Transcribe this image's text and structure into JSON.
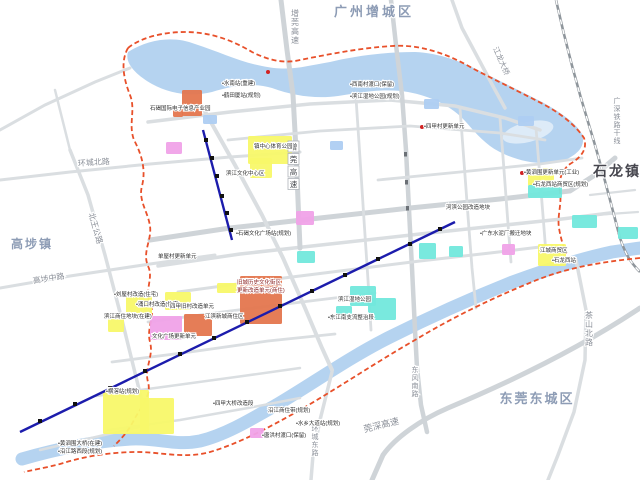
{
  "map": {
    "kind": "town-planning-map",
    "colors": {
      "river": "#b5d3f0",
      "river_light": "#ddebf8",
      "road": "#dadee1",
      "road_major": "#cfd4d8",
      "rail": "#8f969c",
      "boundary": "#e8502a",
      "metro": "#1c1cac",
      "station": "#111111",
      "parcel_yellow": "#f8f869",
      "parcel_pink": "#f0a2e8",
      "parcel_cyan": "#72e8dc",
      "parcel_orange": "#e4764e",
      "pond": "#aecdf2",
      "region_text": "#8d9cb5",
      "road_text": "#8a8f98",
      "poi_text": "#2e2e2e"
    },
    "regions": [
      {
        "id": "guangzhou-zengcheng",
        "label": "广州增城区",
        "x": 374,
        "y": 16,
        "size": 13,
        "color": "#8d9cb5",
        "spacing": 3,
        "bold": true
      },
      {
        "id": "shilong",
        "label": "石龙镇",
        "x": 617,
        "y": 176,
        "size": 14,
        "color": "#46464e",
        "spacing": 2,
        "bold": true
      },
      {
        "id": "dongguan-dongcheng",
        "label": "东莞东城区",
        "x": 537,
        "y": 403,
        "size": 13,
        "color": "#8d9cb5",
        "spacing": 2,
        "bold": true
      },
      {
        "id": "gaobu",
        "label": "高埗镇",
        "x": 32,
        "y": 248,
        "size": 12,
        "color": "#8d9cb5",
        "spacing": 2,
        "bold": true
      }
    ],
    "road_labels": [
      {
        "label": "环城北路",
        "x": 94,
        "y": 165,
        "rotate": -4,
        "size": 8
      },
      {
        "label": "北王公路",
        "x": 93,
        "y": 229,
        "rotate": 74,
        "size": 8
      },
      {
        "label": "高埗中路",
        "x": 49,
        "y": 281,
        "rotate": -9,
        "size": 8
      },
      {
        "label": "增莞高速",
        "x": 295,
        "y": 8,
        "vertical": true,
        "size": 8
      },
      {
        "label": "江龙大桥",
        "x": 499,
        "y": 62,
        "rotate": 66,
        "size": 7.5
      },
      {
        "label": "广深铁路干线",
        "x": 617,
        "y": 96,
        "vertical": true,
        "size": 7
      },
      {
        "label": "茶山北路",
        "x": 589,
        "y": 310,
        "vertical": true,
        "size": 8
      },
      {
        "label": "东风南路",
        "x": 415,
        "y": 365,
        "vertical": true,
        "size": 7
      },
      {
        "label": "环城东路",
        "x": 315,
        "y": 424,
        "vertical": true,
        "size": 7
      },
      {
        "label": "莞深高速",
        "x": 382,
        "y": 428,
        "rotate": -14,
        "size": 9
      }
    ],
    "expressway_shield": {
      "chars": [
        "增",
        "莞",
        "高",
        "速"
      ],
      "x": 288,
      "y": 141,
      "box": 11
    },
    "parcels": [
      {
        "color": "parcel_orange",
        "x": 182,
        "y": 90,
        "w": 20,
        "h": 26
      },
      {
        "color": "parcel_orange",
        "x": 173,
        "y": 108,
        "w": 10,
        "h": 9
      },
      {
        "color": "parcel_orange",
        "x": 240,
        "y": 276,
        "w": 42,
        "h": 48
      },
      {
        "color": "parcel_orange",
        "x": 184,
        "y": 314,
        "w": 28,
        "h": 22
      },
      {
        "color": "parcel_yellow",
        "x": 248,
        "y": 136,
        "w": 44,
        "h": 28
      },
      {
        "color": "parcel_yellow",
        "x": 250,
        "y": 158,
        "w": 22,
        "h": 20
      },
      {
        "color": "parcel_yellow",
        "x": 538,
        "y": 244,
        "w": 28,
        "h": 22
      },
      {
        "color": "parcel_yellow",
        "x": 528,
        "y": 168,
        "w": 26,
        "h": 18
      },
      {
        "color": "parcel_yellow",
        "x": 103,
        "y": 390,
        "w": 46,
        "h": 44
      },
      {
        "color": "parcel_yellow",
        "x": 140,
        "y": 398,
        "w": 34,
        "h": 36
      },
      {
        "color": "parcel_yellow",
        "x": 126,
        "y": 294,
        "w": 26,
        "h": 22
      },
      {
        "color": "parcel_yellow",
        "x": 165,
        "y": 292,
        "w": 26,
        "h": 18
      },
      {
        "color": "parcel_yellow",
        "x": 108,
        "y": 316,
        "w": 16,
        "h": 16
      },
      {
        "color": "parcel_yellow",
        "x": 217,
        "y": 283,
        "w": 20,
        "h": 10
      },
      {
        "color": "parcel_pink",
        "x": 150,
        "y": 316,
        "w": 32,
        "h": 24
      },
      {
        "color": "parcel_pink",
        "x": 296,
        "y": 211,
        "w": 18,
        "h": 14
      },
      {
        "color": "parcel_pink",
        "x": 166,
        "y": 142,
        "w": 16,
        "h": 12
      },
      {
        "color": "parcel_pink",
        "x": 502,
        "y": 244,
        "w": 13,
        "h": 11
      },
      {
        "color": "parcel_pink",
        "x": 250,
        "y": 428,
        "w": 14,
        "h": 10
      },
      {
        "color": "parcel_cyan",
        "x": 350,
        "y": 286,
        "w": 26,
        "h": 20
      },
      {
        "color": "parcel_cyan",
        "x": 368,
        "y": 298,
        "w": 28,
        "h": 22
      },
      {
        "color": "parcel_cyan",
        "x": 336,
        "y": 306,
        "w": 16,
        "h": 14
      },
      {
        "color": "parcel_cyan",
        "x": 528,
        "y": 185,
        "w": 34,
        "h": 13
      },
      {
        "color": "parcel_cyan",
        "x": 419,
        "y": 243,
        "w": 17,
        "h": 16
      },
      {
        "color": "parcel_cyan",
        "x": 449,
        "y": 246,
        "w": 14,
        "h": 11
      },
      {
        "color": "parcel_cyan",
        "x": 572,
        "y": 215,
        "w": 25,
        "h": 13
      },
      {
        "color": "parcel_cyan",
        "x": 618,
        "y": 227,
        "w": 20,
        "h": 12
      },
      {
        "color": "parcel_cyan",
        "x": 297,
        "y": 251,
        "w": 18,
        "h": 12
      },
      {
        "color": "pond",
        "x": 203,
        "y": 115,
        "w": 14,
        "h": 9
      },
      {
        "color": "pond",
        "x": 330,
        "y": 141,
        "w": 13,
        "h": 9
      },
      {
        "color": "pond",
        "x": 518,
        "y": 116,
        "w": 16,
        "h": 10
      },
      {
        "color": "pond",
        "x": 424,
        "y": 99,
        "w": 15,
        "h": 10
      }
    ],
    "poi_labels": [
      {
        "text": "•水南站(重建)",
        "x": 222,
        "y": 85
      },
      {
        "text": "•鹤田厦站(规划)",
        "x": 222,
        "y": 97
      },
      {
        "text": "•西南村渡口(保留)",
        "x": 350,
        "y": 86
      },
      {
        "text": "•滨江湿地公园(规划)",
        "x": 350,
        "y": 98
      },
      {
        "text": "石碣国际电子信息产业园",
        "x": 150,
        "y": 110
      },
      {
        "text": "•四甲村更新单元",
        "x": 424,
        "y": 128
      },
      {
        "text": "镇中心体育公园",
        "x": 254,
        "y": 148
      },
      {
        "text": "滨江文化中心区",
        "x": 226,
        "y": 175
      },
      {
        "text": "•黄泗围更新单元(工业)",
        "x": 524,
        "y": 174
      },
      {
        "text": "•石龙西站商贸区(规划)",
        "x": 533,
        "y": 186
      },
      {
        "text": "河滨公园改造地块",
        "x": 446,
        "y": 209
      },
      {
        "text": "•广东水泥厂搬迁地块",
        "x": 480,
        "y": 235
      },
      {
        "text": "•石碣文化广场站(规划)",
        "x": 236,
        "y": 235
      },
      {
        "text": "单屋村更新单元",
        "x": 158,
        "y": 258
      },
      {
        "text": "旧城历史文化街区",
        "x": 237,
        "y": 284,
        "color": "#8a2020"
      },
      {
        "text": "更新改造单元(商住)",
        "x": 237,
        "y": 292,
        "color": "#8a2020"
      },
      {
        "text": "•刘屋村改造(住宅)",
        "x": 114,
        "y": 296
      },
      {
        "text": "•涌口村改造(住宅)",
        "x": 136,
        "y": 306
      },
      {
        "text": "滨江商住地块(在建)",
        "x": 104,
        "y": 318
      },
      {
        "text": "四甲旧村改造单元",
        "x": 170,
        "y": 308
      },
      {
        "text": "江滨新城商住区",
        "x": 205,
        "y": 318
      },
      {
        "text": "文化广场更新单元",
        "x": 152,
        "y": 338
      },
      {
        "text": "•横滘站(规划)",
        "x": 106,
        "y": 393
      },
      {
        "text": "•四甲大桥改造段",
        "x": 213,
        "y": 405
      },
      {
        "text": "沿江商住带(规划)",
        "x": 268,
        "y": 412
      },
      {
        "text": "•水乡大道站(规划)",
        "x": 296,
        "y": 425
      },
      {
        "text": "•唐洪村渡口(保留)",
        "x": 262,
        "y": 437
      },
      {
        "text": "•黄泗围大桥(在建)",
        "x": 58,
        "y": 445
      },
      {
        "text": "•沿江路西段(规划)",
        "x": 58,
        "y": 453
      },
      {
        "text": "滨江湿地公园",
        "x": 338,
        "y": 301
      },
      {
        "text": "•东江南支流整治段",
        "x": 328,
        "y": 319
      },
      {
        "text": "江城商贸区",
        "x": 540,
        "y": 252
      },
      {
        "text": "•石龙西站",
        "x": 552,
        "y": 262
      }
    ],
    "markers": [
      {
        "x": 268,
        "y": 72,
        "color": "#d22222"
      },
      {
        "x": 422,
        "y": 127,
        "color": "#d22222"
      },
      {
        "x": 522,
        "y": 173,
        "color": "#d22222"
      }
    ]
  }
}
